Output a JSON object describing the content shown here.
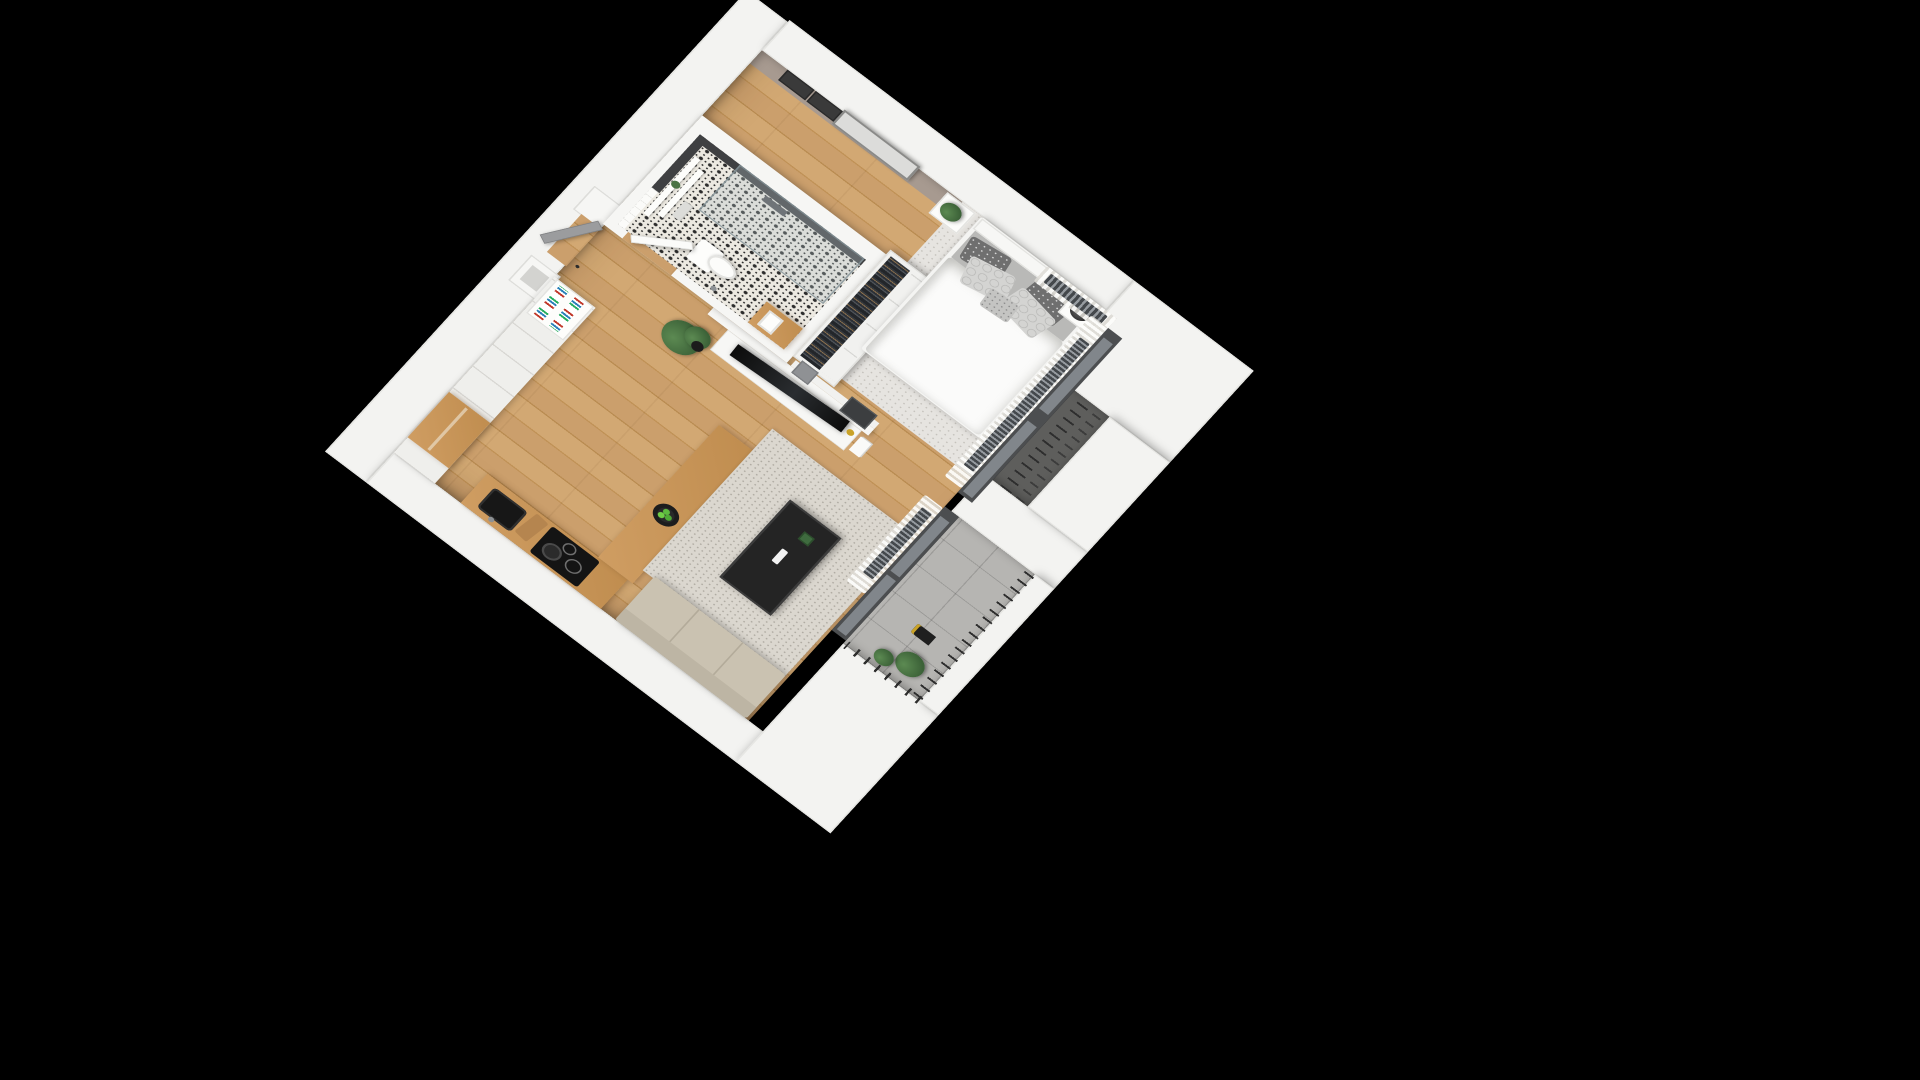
{
  "scene": {
    "type": "isometric-3d-floor-plan-render",
    "background_color": "#000000",
    "view": "axonometric top-down, apartment rotated diagonally on black backdrop",
    "apartment": "studio apartment with open kitchen/living room, hallway, bathroom, bedroom and loggia balcony"
  },
  "palette": {
    "exterior_wall": "#f3f3f1",
    "interior_wall": "#f6f6f4",
    "wood_floor": "#c89b63",
    "counter_wood": "#c8965a",
    "taupe_accent_wall": "#a79a90",
    "bathroom_dark_tile": "#3f4042",
    "bathroom_floor_pattern": "#2d2d2d on #ece9e1",
    "balcony_concrete": "#b6b5b2",
    "railing_metal": "#2e2e2e",
    "rug": "#dbd7cf",
    "sofa_beige": "#cac2b1",
    "coffee_table_black": "#242424",
    "bed_linen_white": "#fbfbfa",
    "pillow_dark_grey": "#6f6f6f",
    "pillow_light_grey": "#d4d4d2",
    "plant_green": "#4a7344",
    "candle_gold": "#c9a227"
  },
  "rooms": [
    {
      "name": "kitchen-living-room",
      "floor": "wood planks",
      "furniture": [
        "tall white cabinet run",
        "wood niche shelf",
        "open bookshelf with books",
        "L-shaped wood counter",
        "black undermount sink",
        "induction hob with pan",
        "cutting board",
        "wood breakfast peninsula",
        "bowl of green apples",
        "two grey bar stools",
        "beige lounge sofa",
        "speckled grey rug",
        "black metal coffee table with remote and plant",
        "white TV sideboard",
        "flat-screen TV",
        "gold candle",
        "magazines",
        "large potted plant",
        "white curtains",
        "radiator",
        "glass balcony door"
      ]
    },
    {
      "name": "hallway",
      "floor": "wood planks",
      "furniture": [
        "grey entry door",
        "ventilation shaft",
        "second ventilation shaft"
      ]
    },
    {
      "name": "bathroom",
      "floor": "black-white ornament tile",
      "furniture": [
        "white subway tile wall",
        "dark charcoal tile wall",
        "floating shelves with towels and plant",
        "wall-hung toilet",
        "toilet paper holder",
        "glass walk-in shower",
        "wood vanity bench with white basin",
        "white interior door ajar"
      ]
    },
    {
      "name": "bedroom",
      "floor": "wood planks with light rug",
      "furniture": [
        "open wardrobe with hanging clothes",
        "double bed with white duvet",
        "grey patterned pillows",
        "white headboard",
        "nightstand with plant",
        "nightstand with black table lamp",
        "large framed abstract art",
        "two small dark framed prints",
        "taupe accent wall",
        "storage niche with grey bins and black boxes",
        "white curtains",
        "two radiators",
        "window with french-balcony railing"
      ]
    },
    {
      "name": "balcony-loggia",
      "floor": "concrete tiles",
      "furniture": [
        "black vertical-bar railing",
        "black lantern",
        "planter greenery",
        "white parapet walls",
        "white dividing pillar"
      ]
    }
  ]
}
